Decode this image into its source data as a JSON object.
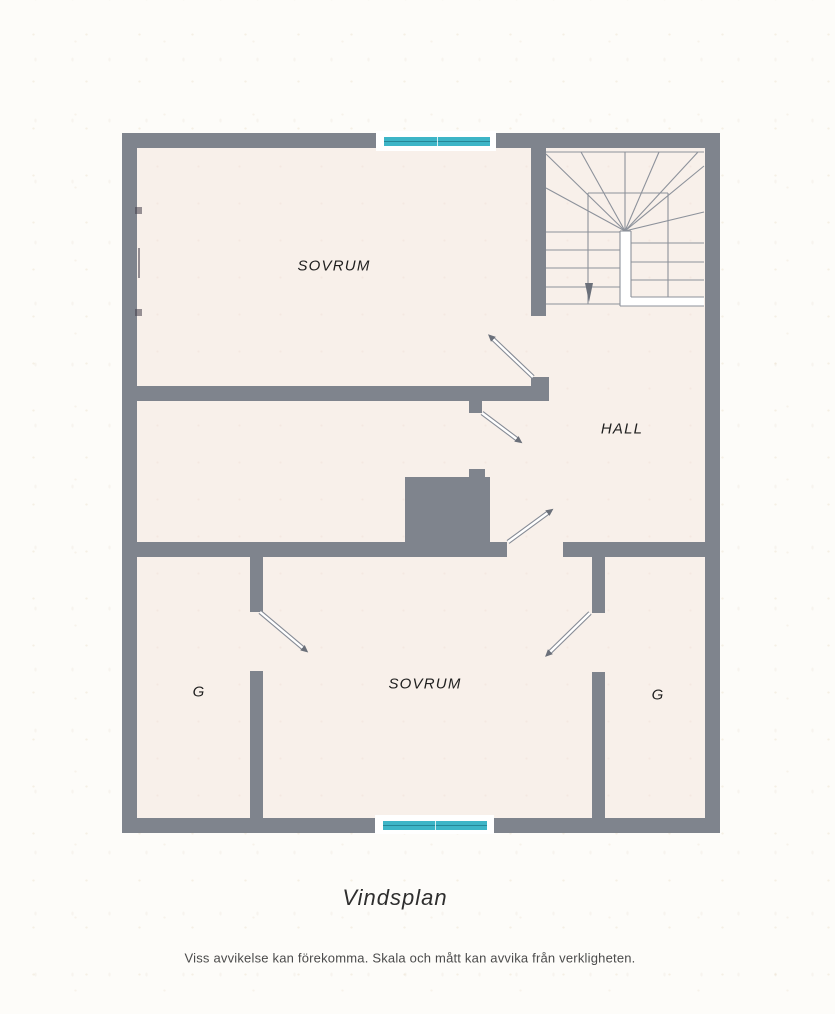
{
  "plan": {
    "caption": "Vindsplan",
    "disclaimer": "Viss avvikelse kan förekomma. Skala och mått kan avvika från verkligheten.",
    "labels": {
      "sovrum_top": "SOVRUM",
      "hall": "HALL",
      "sovrum_bottom": "SOVRUM",
      "closet_left": "G",
      "closet_right": "G"
    },
    "icons": {
      "stair_direction": "down-arrow",
      "door_symbol": "door-swing-arrow",
      "window_symbol": "window-glass"
    },
    "colors": {
      "wall": "#7f848d",
      "floor": "#f8f0ea",
      "window_glass": "#3db5c7",
      "window_frame": "#ffffff",
      "stair_line": "#8d929b",
      "label_text": "#1f1f1f",
      "caption_text": "#2e2e2e",
      "disclaimer_text": "#4b4b4b"
    }
  }
}
